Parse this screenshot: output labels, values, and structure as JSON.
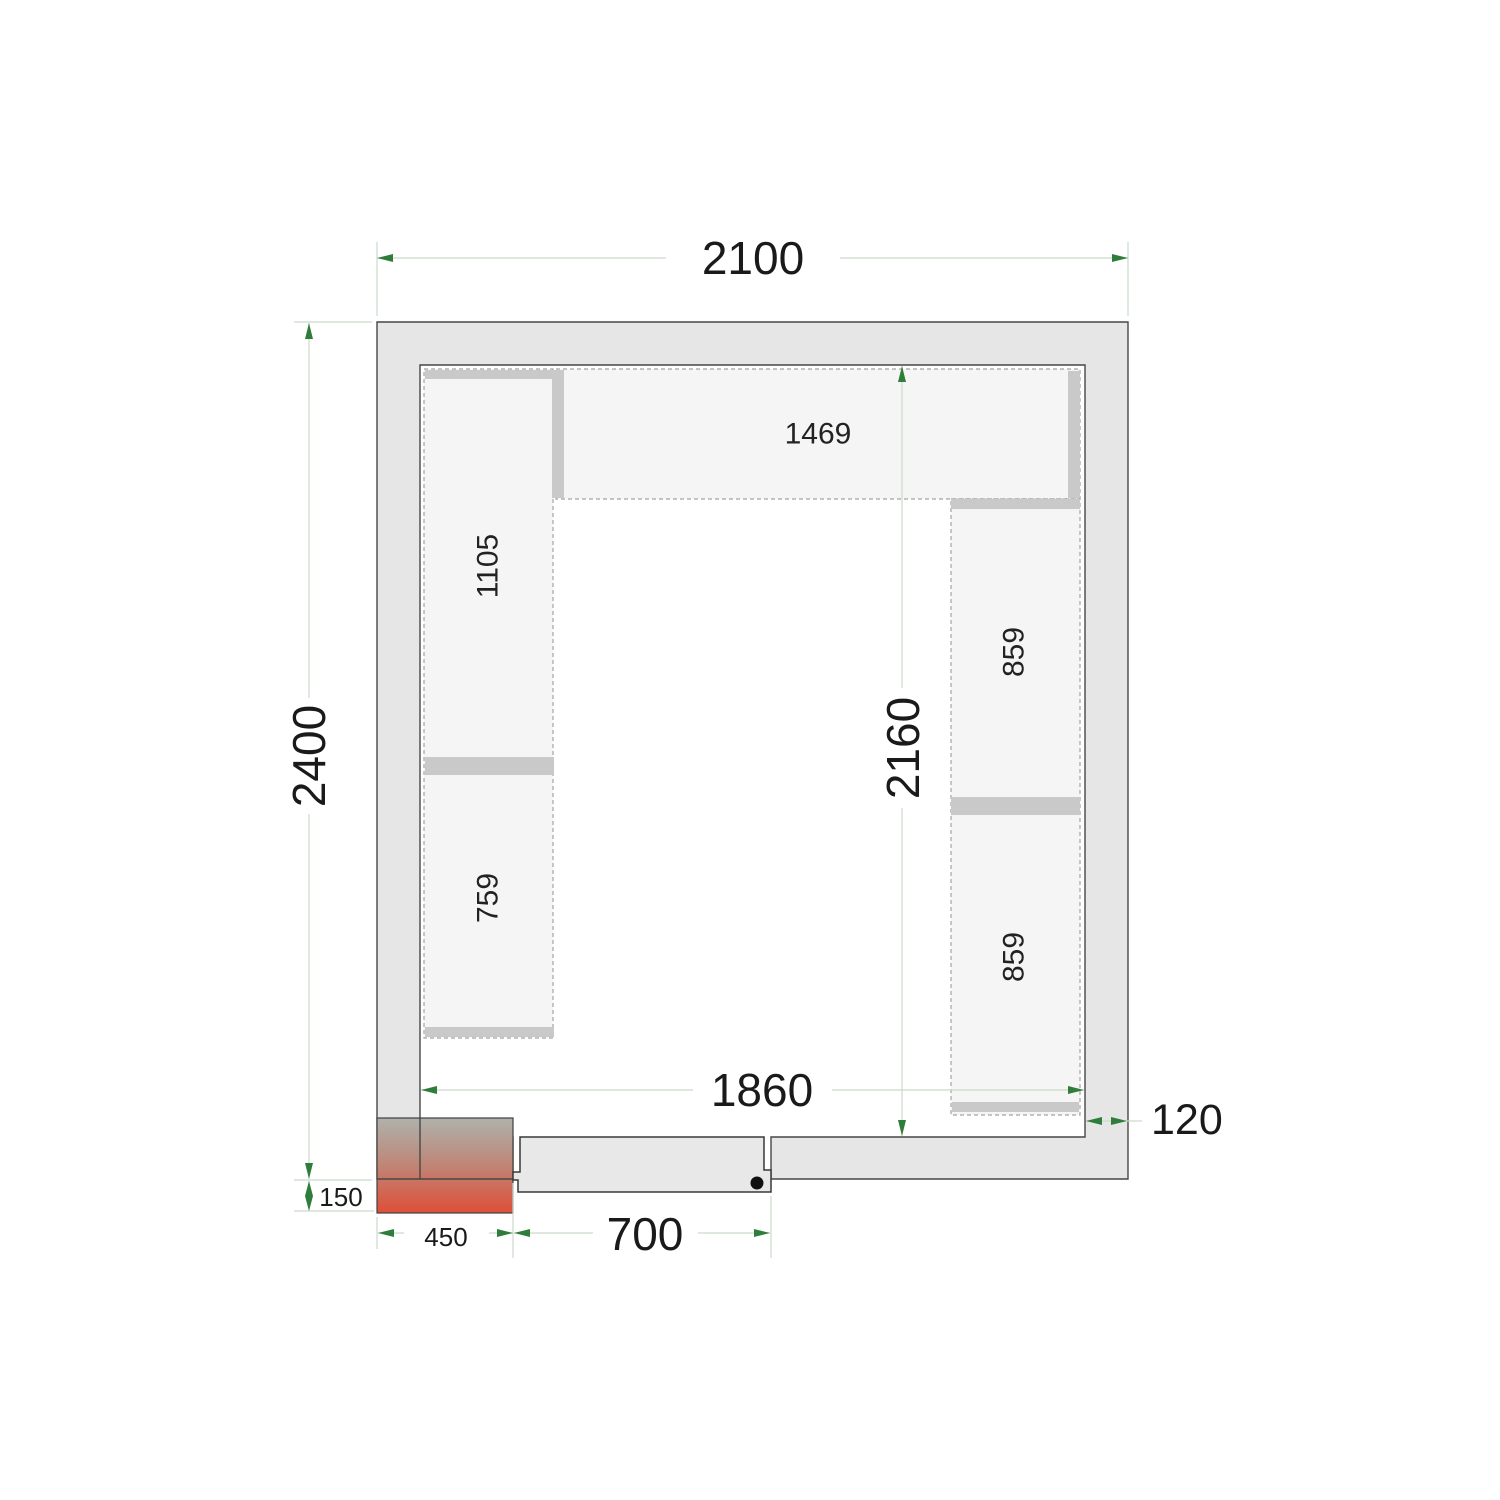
{
  "drawing": {
    "type": "cold-room-floor-plan-top-view",
    "dimensions": {
      "outer_width": "2100",
      "outer_depth": "2400",
      "inner_width": "1860",
      "inner_depth": "2160",
      "wall_thickness": "120",
      "unit_offset": "150",
      "unit_width": "450",
      "door_width": "700"
    },
    "shelves": {
      "top": "1469",
      "left_upper": "1105",
      "left_lower": "759",
      "right_upper": "859",
      "right_lower": "859"
    },
    "colors": {
      "dimension_arrow_green": "#2e7d3a",
      "dimension_line": "#ccdacc",
      "wall_fill": "#e6e6e6",
      "shelf_fill": "#f5f5f5",
      "shelf_support_bar": "#c9c9c9",
      "unit_gradient_top": "#aeb2ab",
      "unit_gradient_mid": "#bd8a7c",
      "unit_gradient_bottom": "#de4f37"
    }
  }
}
